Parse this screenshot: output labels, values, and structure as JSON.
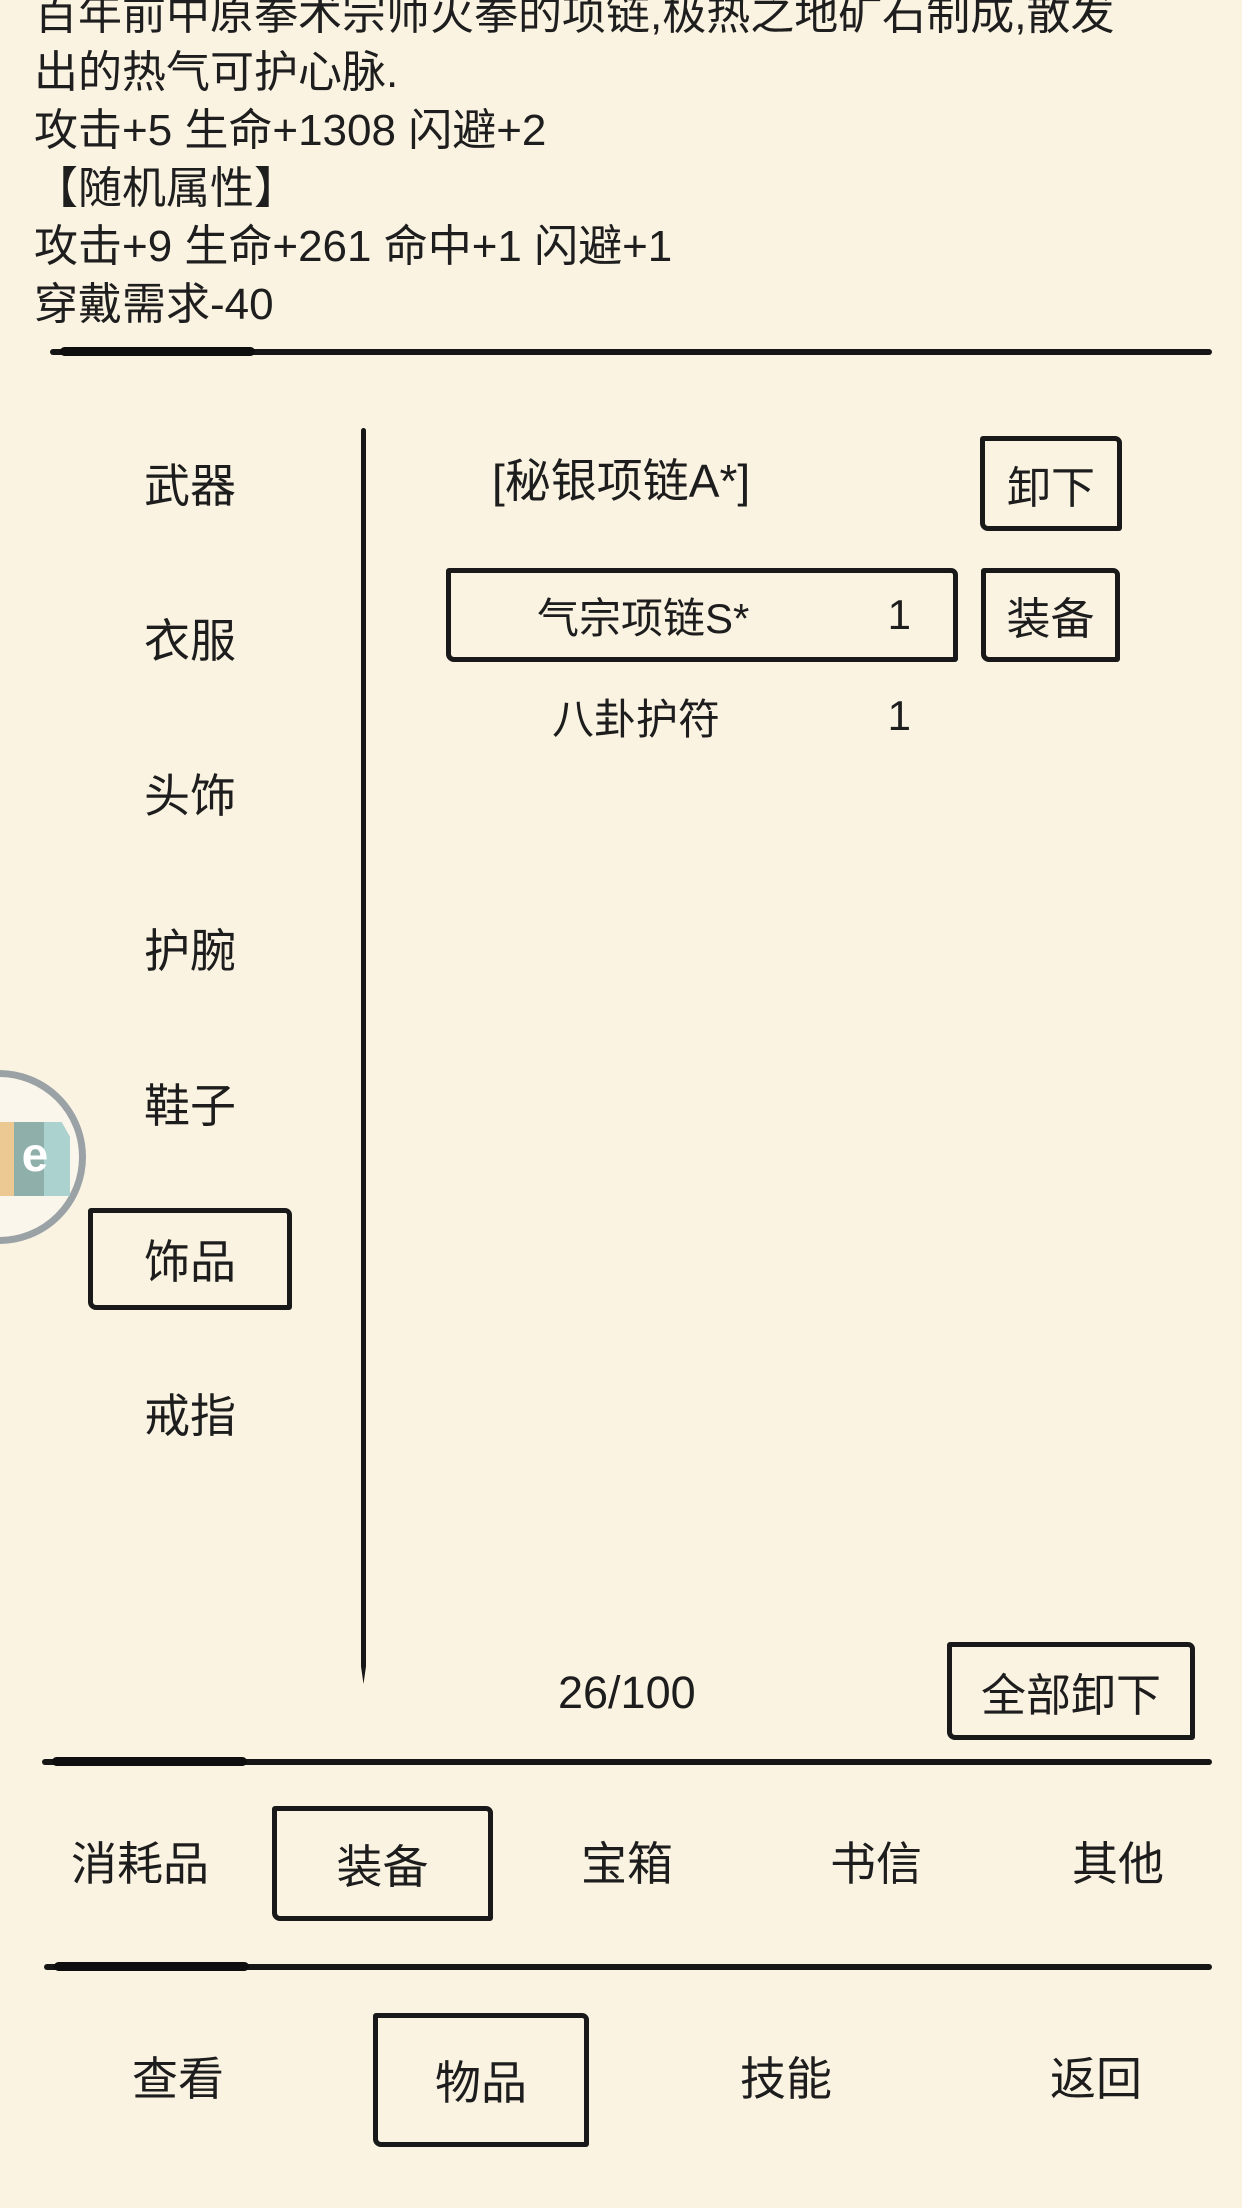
{
  "colors": {
    "background": "#faf3e2",
    "ink": "#161616",
    "badge_ring": "#9aa2a6",
    "badge_tan": "#ecc893",
    "badge_teal_dark": "#8fafab",
    "badge_teal_light": "#abd2cf"
  },
  "item_detail": {
    "lines": [
      "百年前中原拳术宗师火拳的项链,极热之地矿石制成,散发",
      "出的热气可护心脉.",
      "攻击+5 生命+1308 闪避+2",
      "【随机属性】",
      "攻击+9 生命+261 命中+1 闪避+1",
      "穿戴需求-40"
    ]
  },
  "sidebar": {
    "items": [
      {
        "label": "武器",
        "selected": false
      },
      {
        "label": "衣服",
        "selected": false
      },
      {
        "label": "头饰",
        "selected": false
      },
      {
        "label": "护腕",
        "selected": false
      },
      {
        "label": "鞋子",
        "selected": false
      },
      {
        "label": "饰品",
        "selected": true
      },
      {
        "label": "戒指",
        "selected": false
      }
    ]
  },
  "panel": {
    "equipped_name": "[秘银项链A*]",
    "unequip_label": "卸下",
    "rows": [
      {
        "name": "气宗项链S*",
        "count": "1",
        "action_label": "装备",
        "highlighted": true
      },
      {
        "name": "八卦护符",
        "count": "1"
      }
    ],
    "capacity": "26/100",
    "unequip_all_label": "全部卸下"
  },
  "category_tabs": {
    "items": [
      {
        "label": "消耗品",
        "selected": false
      },
      {
        "label": "装备",
        "selected": true
      },
      {
        "label": "宝箱",
        "selected": false
      },
      {
        "label": "书信",
        "selected": false
      },
      {
        "label": "其他",
        "selected": false
      }
    ]
  },
  "bottom_nav": {
    "items": [
      {
        "label": "查看",
        "selected": false
      },
      {
        "label": "物品",
        "selected": true
      },
      {
        "label": "技能",
        "selected": false
      },
      {
        "label": "返回",
        "selected": false
      }
    ]
  },
  "floating_badge": {
    "letter": "e"
  }
}
